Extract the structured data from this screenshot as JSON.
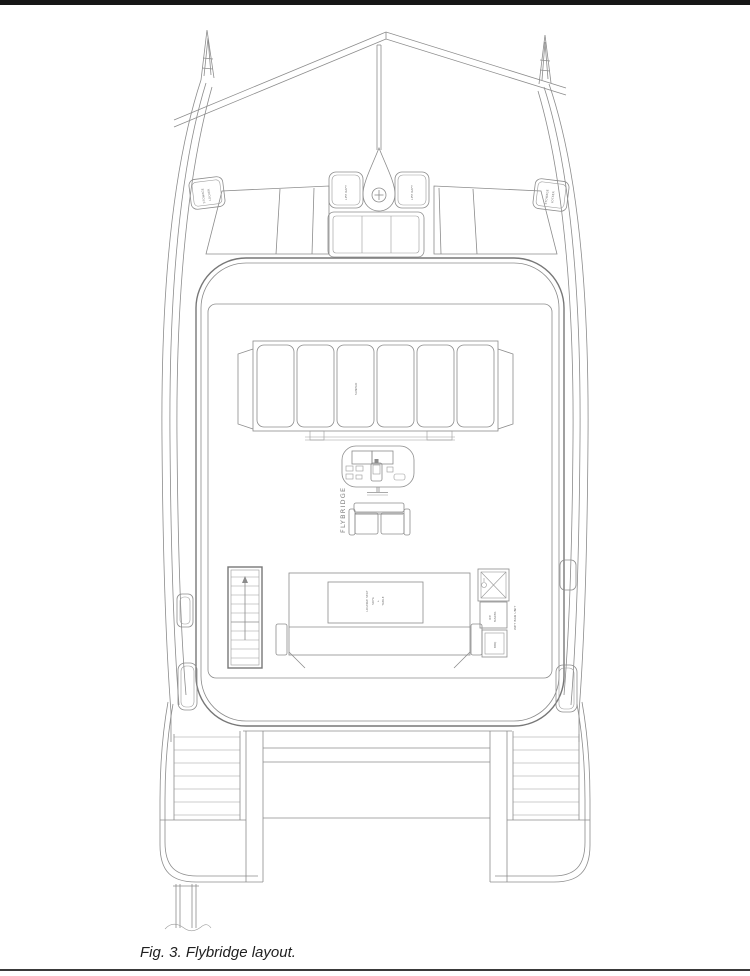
{
  "page": {
    "background": "#ffffff",
    "top_bar_color": "#161616",
    "line_color": "#8c8c8c",
    "caption": "Fig. 3. Flybridge layout."
  },
  "figure": {
    "labels": {
      "flybridge": "FLYBRIDGE",
      "sunpad": "SUNPAD",
      "stowage_locker": {
        "line1": "STOWAGE",
        "line2": "LOCKER"
      },
      "life_raft": "LIFE RAFT",
      "lounge_table": [
        "LOUNGE SEAT",
        "SOFA",
        "+",
        "TABLE"
      ],
      "wet_bar": {
        "fridge_line1": "ICE",
        "fridge_line2": "MAKER",
        "grill": "BBQ",
        "unit": "WET BAR UNIT"
      }
    }
  }
}
